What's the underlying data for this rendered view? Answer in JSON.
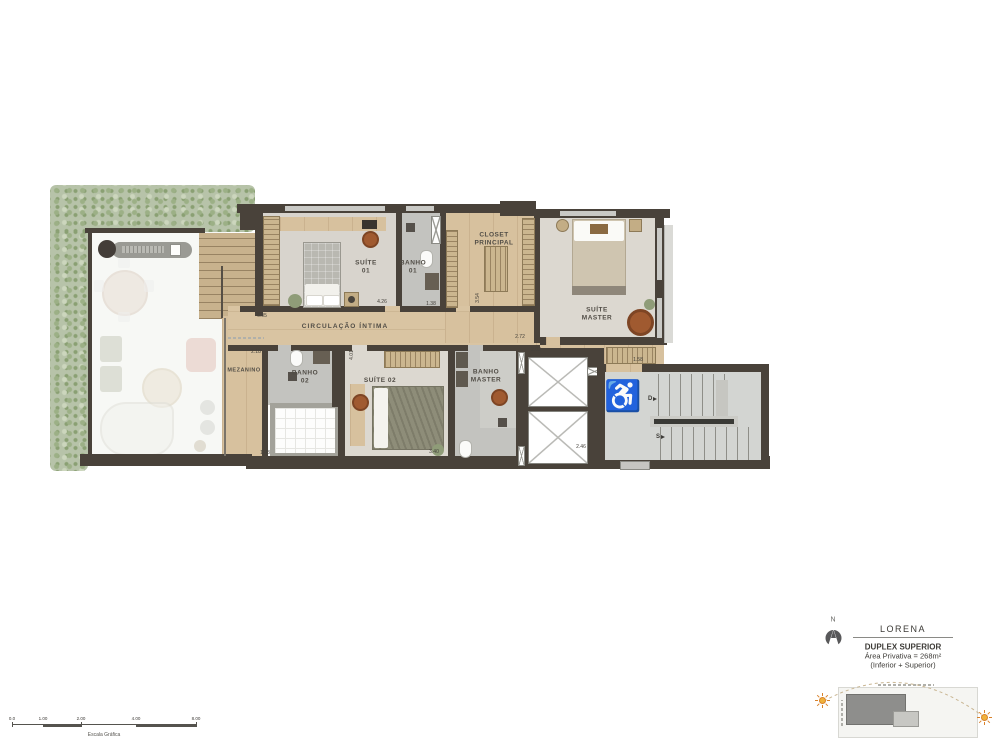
{
  "plan": {
    "rooms": {
      "suite01": "SUÍTE\n01",
      "banho01": "BANHO\n01",
      "closet_principal": "CLOSET\nPRINCIPAL",
      "suite_master": "SUÍTE\nMASTER",
      "circulacao": "CIRCULAÇÃO ÍNTIMA",
      "mezanino": "MEZANINO",
      "banho02": "BANHO\n02",
      "suite02": "SUÍTE 02",
      "banho_master": "BANHO\nMASTER"
    },
    "stair_labels": {
      "down": "D",
      "up": "S"
    },
    "dimensions": [
      "6.05",
      "4.26",
      "1.38",
      "3.54",
      "2.72",
      "2.18",
      "4.01",
      "2.02",
      "1.43",
      "3.40",
      "2.46",
      "1.58"
    ]
  },
  "legend": {
    "north_letter": "N",
    "project_name": "LORENA",
    "unit_title": "DUPLEX SUPERIOR",
    "area_line": "Área Privativa = 268m²",
    "floors_line": "(Inferior + Superior)"
  },
  "scale_bar": {
    "ticks": [
      "0.0",
      "1.00",
      "2.00",
      "4.00",
      "8.00"
    ],
    "caption": "Escala Gráfica"
  },
  "colors": {
    "wall": "#49423a",
    "wood": "#d7c19e",
    "hedge": "#b7c3a9",
    "accent_furniture": "#a05a30",
    "bath_floor": "#c3c3bf",
    "carpet_floor": "#d8d4cd"
  }
}
